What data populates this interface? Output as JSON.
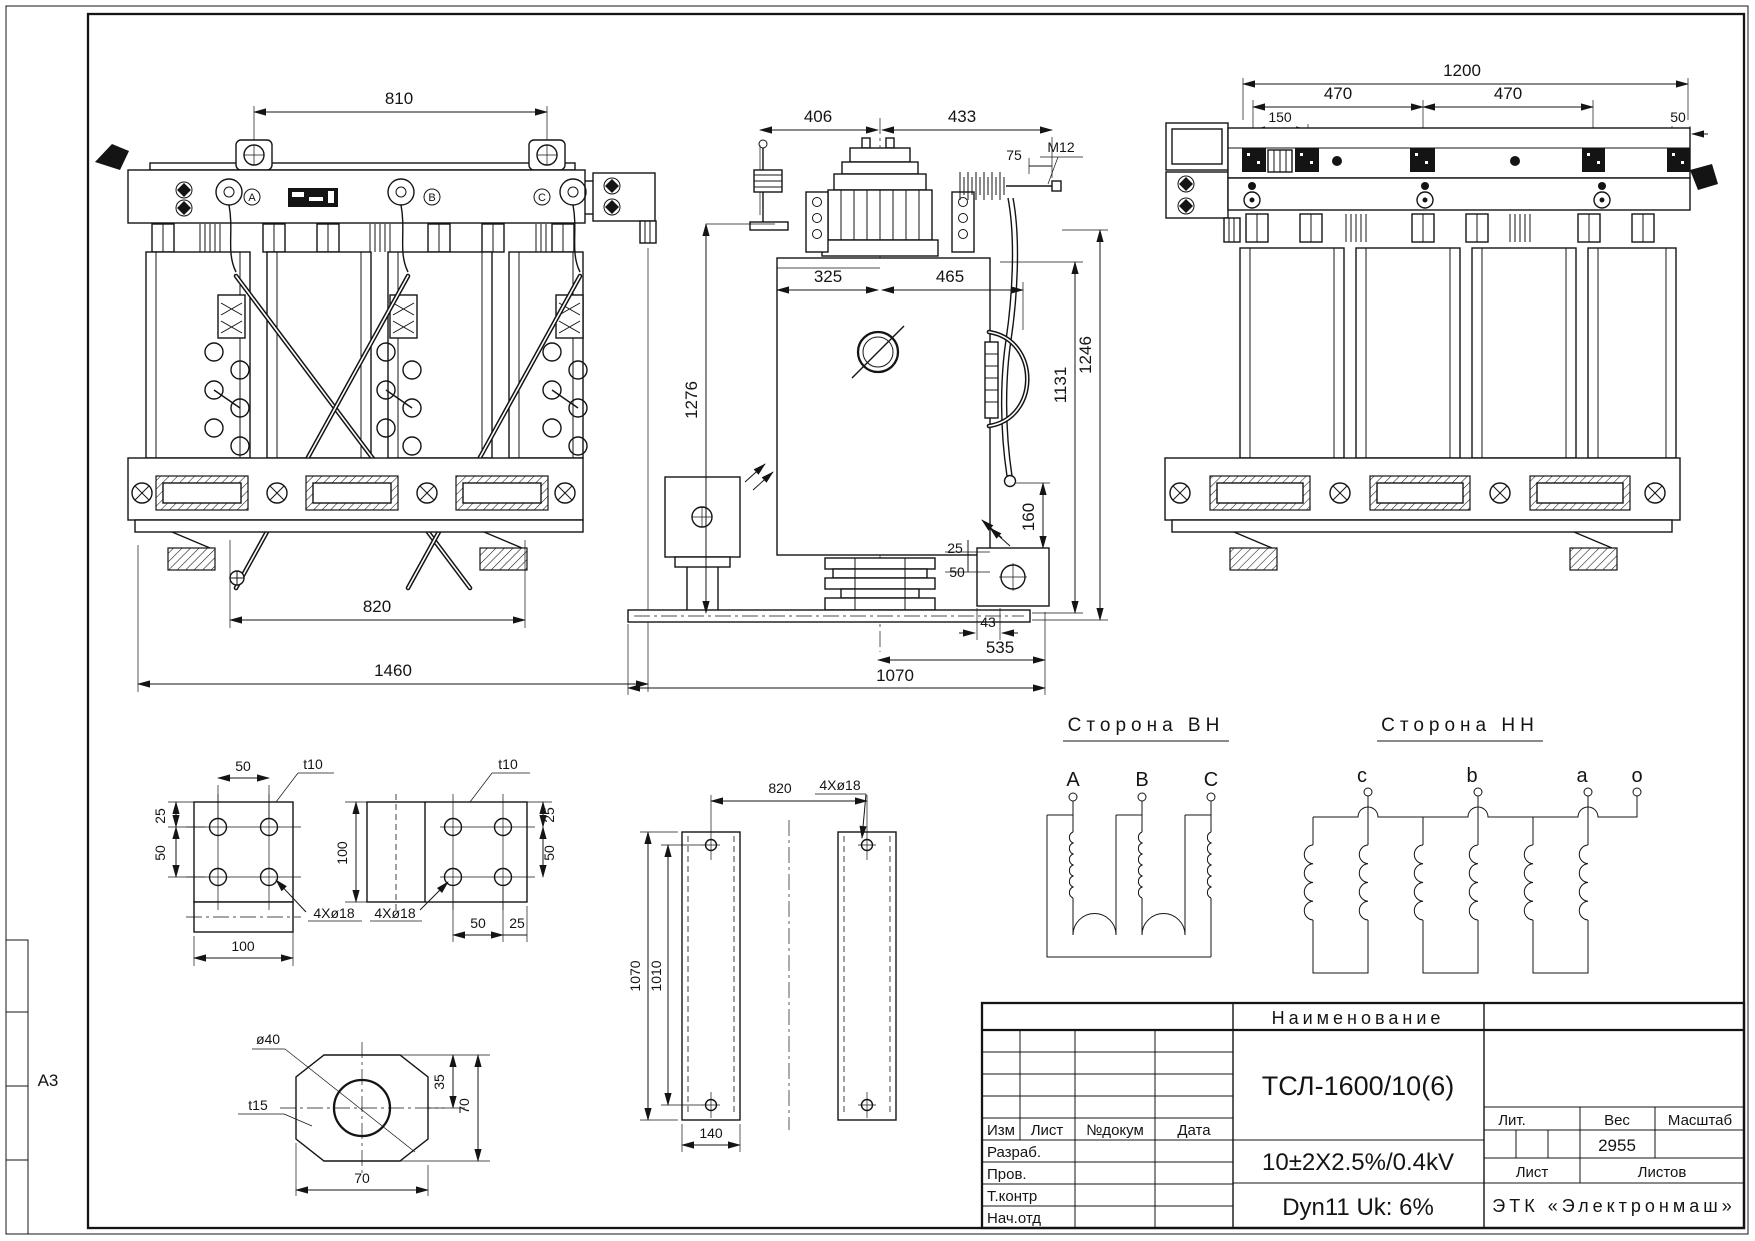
{
  "sheet": {
    "format": "A3"
  },
  "views": {
    "front": {
      "d810": "810",
      "d820": "820",
      "d1460": "1460",
      "phases": [
        "A",
        "B",
        "C"
      ]
    },
    "side": {
      "d406": "406",
      "d433": "433",
      "d75": "75",
      "m12": "M12",
      "d325": "325",
      "d465": "465",
      "d1276": "1276",
      "d1131": "1131",
      "d1246": "1246",
      "d160": "160",
      "d25": "25",
      "d50": "50",
      "d43": "43",
      "d535": "535",
      "d1070": "1070"
    },
    "rear": {
      "d1200": "1200",
      "d470a": "470",
      "d470b": "470",
      "d150": "150",
      "d50": "50"
    }
  },
  "details": {
    "plate1": {
      "t": "t10",
      "holes": "4Xø18",
      "d50top": "50",
      "d25": "25",
      "d50": "50",
      "d100": "100"
    },
    "plate2": {
      "t": "t10",
      "holes": "4Xø18",
      "d100": "100",
      "d25r": "25",
      "d50r": "50",
      "d50b": "50",
      "d25b": "25"
    },
    "pad": {
      "dia": "ø40",
      "t": "t15",
      "d35": "35",
      "d70r": "70",
      "d70b": "70"
    },
    "rails": {
      "d820": "820",
      "holes": "4Xø18",
      "d1070": "1070",
      "d1010": "1010",
      "d140": "140"
    }
  },
  "schematics": {
    "hv": {
      "title": "Сторона ВН",
      "terminals": [
        "A",
        "B",
        "C"
      ]
    },
    "lv": {
      "title": "Сторона НН",
      "terminals": [
        "c",
        "b",
        "a",
        "o"
      ]
    }
  },
  "title_block": {
    "name_header": "Наименование",
    "model": "ТСЛ-1600/10(6)",
    "regulation": "10±2X2.5%/0.4kV",
    "group": "Dyn11 Uk: 6%",
    "rev": [
      "Изм",
      "Лист",
      "№докум",
      "Дата"
    ],
    "signs": [
      "Разраб.",
      "Пров.",
      "Т.контр",
      "Нач.отд"
    ],
    "lit": "Лит.",
    "weight_label": "Вес",
    "scale_label": "Масштаб",
    "weight": "2955",
    "sheet_label": "Лист",
    "sheets_label": "Листов",
    "company": "ЭТК «Электронмаш»"
  }
}
